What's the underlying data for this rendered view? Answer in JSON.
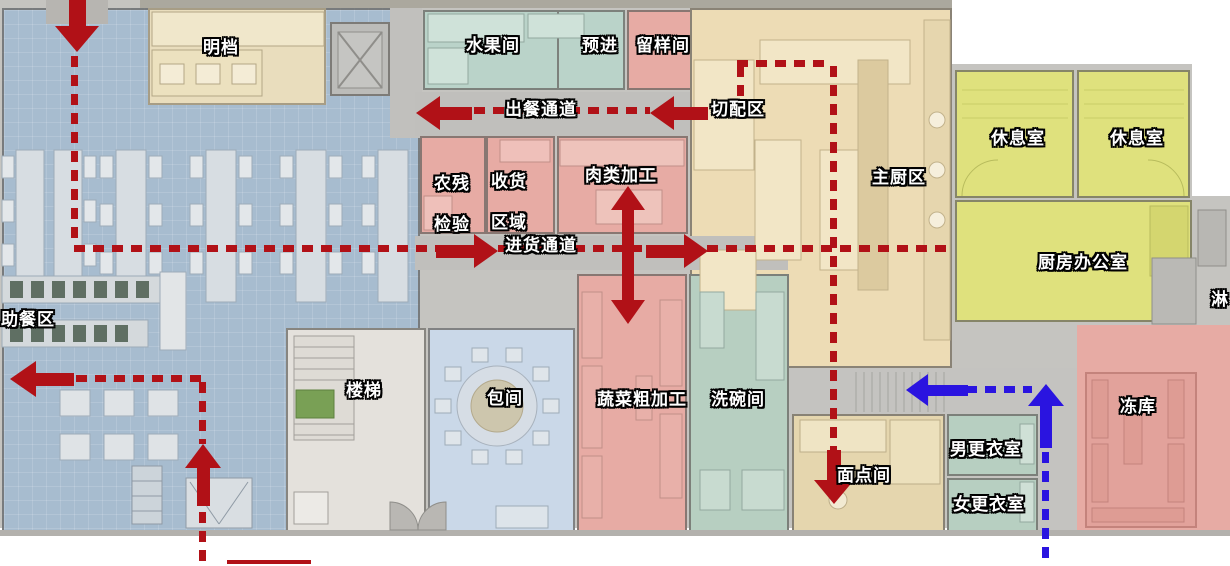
{
  "colors": {
    "route-red": "#b11117",
    "route-blue": "#2a14e0",
    "room-pink": "#e7aba4",
    "room-teal": "#bad3c9",
    "room-sage": "#b7cfc1",
    "room-yellow": "#dfe17d",
    "room-tan": "#eddcb5",
    "room-counter": "#e9ddbd",
    "room-baojian": "#cad8e8",
    "room-stairs": "#e4e1dc",
    "corridor": "#c0bfbc"
  },
  "labels": {
    "mingdang": "明档",
    "shuiguojian": "水果间",
    "yujin": "预进",
    "liuyangjian": "留样间",
    "chucan_tongdao": "出餐通道",
    "qiepeiqu": "切配区",
    "nongcan_l1": "农残",
    "nongcan_l2": "检验",
    "shouhuo_l1": "收货",
    "shouhuo_l2": "区域",
    "roulei_jiagong": "肉类加工",
    "zhuchuqu": "主厨区",
    "jinhuo_tongdao": "进货通道",
    "xiuxishi_1": "休息室",
    "xiuxishi_2": "休息室",
    "chufang_bangongshi": "厨房办公室",
    "lin": "淋",
    "zhucanqu": "助餐区",
    "louti": "楼梯",
    "baojian": "包间",
    "shucai_cujiagong": "蔬菜粗加工",
    "xiwanjian": "洗碗间",
    "miandianjian": "面点间",
    "nan_gengyishi": "男更衣室",
    "nv_gengyishi": "女更衣室",
    "dongku": "冻库"
  }
}
